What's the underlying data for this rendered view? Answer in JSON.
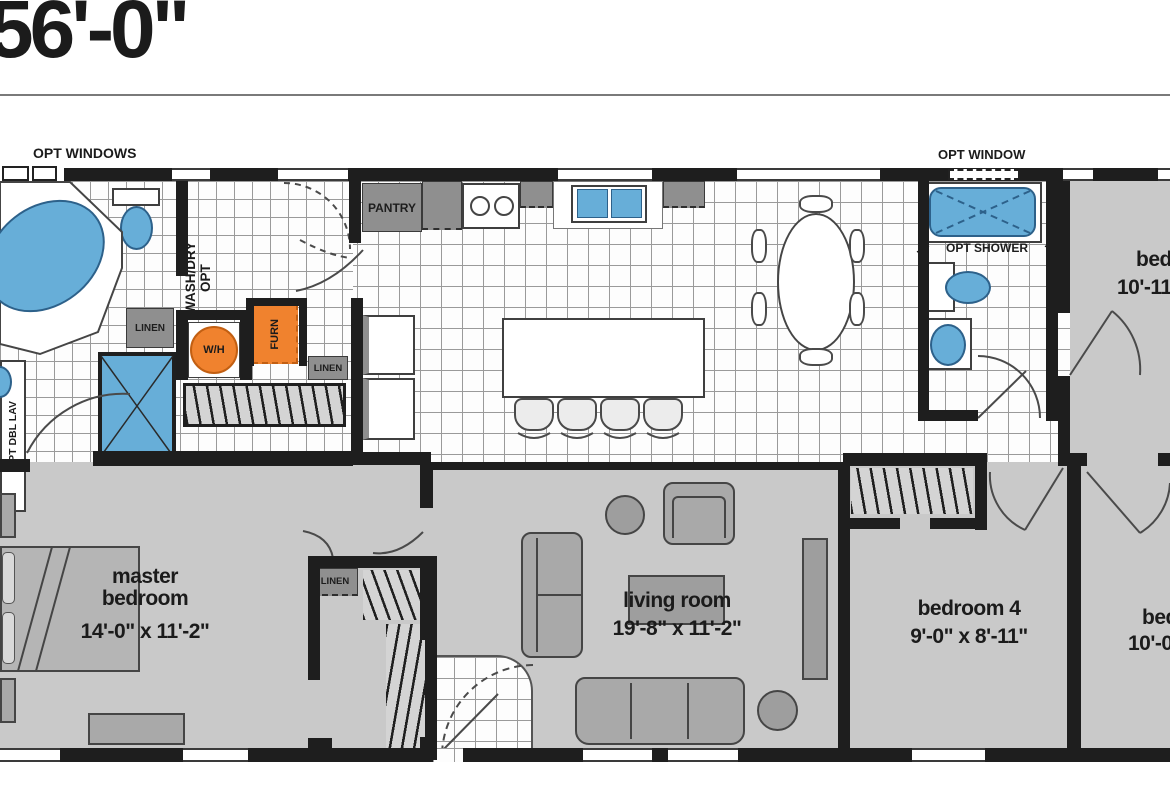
{
  "title": "56'-0\"",
  "annotations": {
    "opt_windows": "OPT WINDOWS",
    "opt_window": "OPT WINDOW",
    "pantry": "PANTRY",
    "wash_dry_line1": "WASH/DRY",
    "wash_dry_line2": "OPT",
    "linen_bath": "LINEN",
    "linen_hall": "LINEN",
    "linen_closet": "LINEN",
    "water_heater": "W/H",
    "furnace": "FURN",
    "opt_shower": "OPT SHOWER",
    "opt_dbl_lav": "OPT DBL LAV"
  },
  "rooms": {
    "master_bedroom": {
      "name": "master bedroom",
      "dims": "14'-0\" x 11'-2\""
    },
    "living_room": {
      "name": "living room",
      "dims": "19'-8\" x 11'-2\""
    },
    "bedroom_4": {
      "name": "bedroom 4",
      "dims": "9'-0\" x 8'-11\""
    },
    "bedroom_2": {
      "name": "bed",
      "dims": "10'-11"
    },
    "bedroom_3": {
      "name": "bed",
      "dims": "10'-0"
    }
  },
  "colors": {
    "wall": "#1e1e1e",
    "carpet": "#c9c9c9",
    "line": "#9a9a9a",
    "box": "#8f8f8f",
    "furniture": "#a9a9a9",
    "blue": "#67aed8",
    "blue_dark": "#2d618a",
    "orange": "#f0822e",
    "orange_dark": "#c25f12"
  }
}
